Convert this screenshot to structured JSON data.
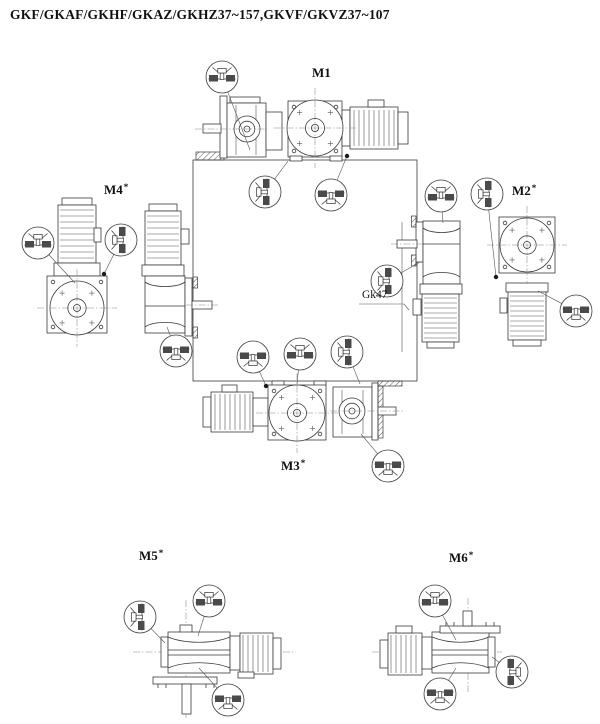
{
  "title": "GKF/GKAF/GKHF/GKAZ/GKHZ37~157,GKVF/GKVZ37~107",
  "positions": {
    "m1": {
      "label": "M1",
      "mark": ""
    },
    "m2": {
      "label": "M2",
      "mark": "*"
    },
    "m3": {
      "label": "M3",
      "mark": "*"
    },
    "m4": {
      "label": "M4",
      "mark": "*"
    },
    "m5": {
      "label": "M5",
      "mark": "*"
    },
    "m6": {
      "label": "M6",
      "mark": "*"
    }
  },
  "annotations": {
    "gear_size_label": "Gk47"
  },
  "colors": {
    "line": "#3a3a3a",
    "symbol_block": "#4a4a4a",
    "leader_dot": "#1a1a1a",
    "text": "#111111"
  },
  "indicators": [
    {
      "id": "m1-vent",
      "symbol": "vent-plug",
      "rotation": "up",
      "x": 222,
      "y": 77,
      "leader": {
        "x": 250,
        "y": 150,
        "dot": false
      }
    },
    {
      "id": "square-top-left",
      "symbol": "level-plug",
      "rotation": "left",
      "x": 265,
      "y": 192,
      "leader": {
        "x": 288,
        "y": 161,
        "dot": false
      }
    },
    {
      "id": "square-top-right",
      "symbol": "drain-plug",
      "rotation": "down",
      "x": 331,
      "y": 195,
      "leader": {
        "x": 347,
        "y": 156,
        "dot": true
      }
    },
    {
      "id": "gk47-level",
      "symbol": "level-plug",
      "rotation": "left",
      "x": 387,
      "y": 281,
      "leader": {
        "x": 420,
        "y": 262,
        "dot": false
      }
    },
    {
      "id": "square-bottom-left",
      "symbol": "drain-plug",
      "rotation": "down",
      "x": 253,
      "y": 357,
      "leader": {
        "x": 266,
        "y": 386,
        "dot": true
      }
    },
    {
      "id": "square-bottom-mid",
      "symbol": "vent-plug",
      "rotation": "up",
      "x": 300,
      "y": 354,
      "leader": {
        "x": 297,
        "y": 384,
        "dot": false
      }
    },
    {
      "id": "square-bottom-right",
      "symbol": "level-plug",
      "rotation": "left",
      "x": 347,
      "y": 352,
      "leader": {
        "x": 360,
        "y": 384,
        "dot": false
      }
    },
    {
      "id": "m4-vent",
      "symbol": "vent-plug",
      "rotation": "up",
      "x": 38,
      "y": 243,
      "leader": {
        "x": 75,
        "y": 283,
        "dot": false
      }
    },
    {
      "id": "m4-level",
      "symbol": "level-plug",
      "rotation": "left",
      "x": 121,
      "y": 240,
      "leader": {
        "x": 104,
        "y": 274,
        "dot": true
      }
    },
    {
      "id": "m4-drain",
      "symbol": "drain-plug",
      "rotation": "down",
      "x": 176,
      "y": 351,
      "leader": {
        "x": 167,
        "y": 327,
        "dot": false
      }
    },
    {
      "id": "m2-vent",
      "symbol": "vent-plug",
      "rotation": "up",
      "x": 441,
      "y": 196,
      "leader": {
        "x": 443,
        "y": 223,
        "dot": false
      }
    },
    {
      "id": "m2-level",
      "symbol": "level-plug",
      "rotation": "left",
      "x": 487,
      "y": 194,
      "leader": {
        "x": 496,
        "y": 277,
        "dot": true
      }
    },
    {
      "id": "m2-drain",
      "symbol": "drain-plug",
      "rotation": "down",
      "x": 576,
      "y": 311,
      "leader": {
        "x": 538,
        "y": 291,
        "dot": false
      }
    },
    {
      "id": "m3-drain",
      "symbol": "drain-plug",
      "rotation": "down",
      "x": 388,
      "y": 466,
      "leader": {
        "x": 361,
        "y": 434,
        "dot": false
      }
    },
    {
      "id": "m5-level",
      "symbol": "level-plug",
      "rotation": "left",
      "x": 140,
      "y": 617,
      "leader": {
        "x": 165,
        "y": 643,
        "dot": false
      }
    },
    {
      "id": "m5-vent",
      "symbol": "vent-plug",
      "rotation": "up",
      "x": 209,
      "y": 601,
      "leader": {
        "x": 198,
        "y": 636,
        "dot": false
      }
    },
    {
      "id": "m5-drain",
      "symbol": "drain-plug",
      "rotation": "down",
      "x": 228,
      "y": 700,
      "leader": {
        "x": 199,
        "y": 668,
        "dot": false
      }
    },
    {
      "id": "m6-vent",
      "symbol": "vent-plug",
      "rotation": "up",
      "x": 435,
      "y": 601,
      "leader": {
        "x": 456,
        "y": 640,
        "dot": false
      }
    },
    {
      "id": "m6-level",
      "symbol": "level-plug",
      "rotation": "right",
      "x": 512,
      "y": 672,
      "leader": {
        "x": 492,
        "y": 657,
        "dot": false
      }
    },
    {
      "id": "m6-drain",
      "symbol": "drain-plug",
      "rotation": "down",
      "x": 440,
      "y": 694,
      "leader": {
        "x": 456,
        "y": 668,
        "dot": false
      }
    }
  ]
}
